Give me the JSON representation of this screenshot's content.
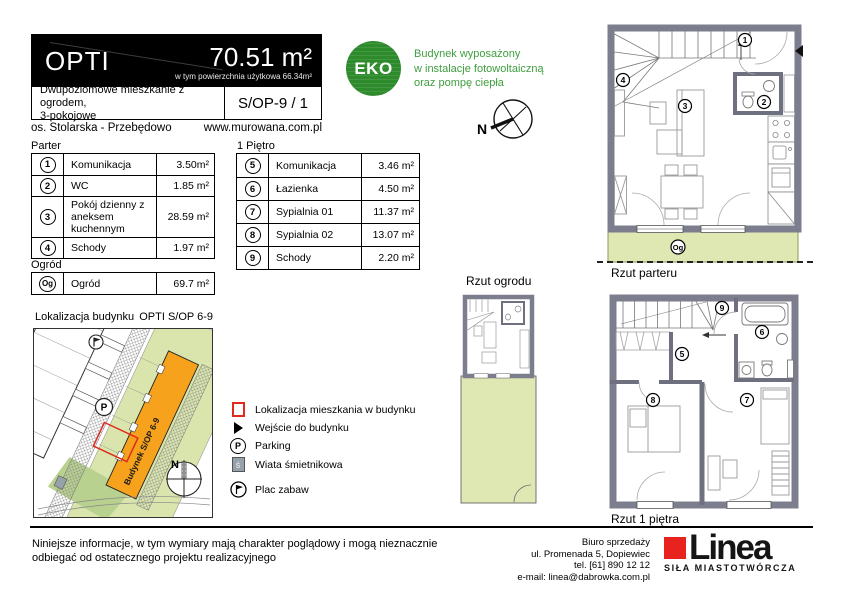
{
  "header": {
    "name": "OPTI",
    "area": "70.51 m²",
    "area_note": "w tym powierzchnia użytkowa  66.34m²",
    "description_line1": "Dwupoziomowe mieszkanie z ogrodem,",
    "description_line2": "3-pokojowe",
    "unit_code": "S/OP-9 / 1",
    "location": "os. Stolarska - Przebędowo",
    "website": "www.murowana.com.pl"
  },
  "eco": {
    "badge": "EKO",
    "line1": "Budynek wyposażony",
    "line2": "w instalacje fotowoltaiczną",
    "line3": "oraz pompę ciepła"
  },
  "compass": {
    "north": "N"
  },
  "tables": {
    "ground_floor": {
      "title": "Parter",
      "rows": [
        {
          "no": "1",
          "room": "Komunikacja",
          "area": "3.50m²"
        },
        {
          "no": "2",
          "room": "WC",
          "area": "1.85 m²"
        },
        {
          "no": "3",
          "room": "Pokój dzienny z aneksem kuchennym",
          "area": "28.59 m²"
        },
        {
          "no": "4",
          "room": "Schody",
          "area": "1.97 m²"
        }
      ]
    },
    "first_floor": {
      "title": "1 Piętro",
      "rows": [
        {
          "no": "5",
          "room": "Komunikacja",
          "area": "3.46 m²"
        },
        {
          "no": "6",
          "room": "Łazienka",
          "area": "4.50 m²"
        },
        {
          "no": "7",
          "room": "Sypialnia 01",
          "area": "11.37 m²"
        },
        {
          "no": "8",
          "room": "Sypialnia 02",
          "area": "13.07 m²"
        },
        {
          "no": "9",
          "room": "Schody",
          "area": "2.20 m²"
        }
      ]
    },
    "garden": {
      "title": "Ogród",
      "rows": [
        {
          "no": "Og",
          "room": "Ogród",
          "area": "69.7 m²"
        }
      ]
    }
  },
  "site_plan": {
    "title": "Lokalizacja budynku",
    "building_code": "OPTI S/OP 6-9",
    "building_label": "Budynek S/OP 6-9",
    "parking_letter": "P",
    "legend": [
      {
        "icon": "red-outline-square",
        "label": "Lokalizacja mieszkania w budynku"
      },
      {
        "icon": "entrance-triangle",
        "label": "Wejście do budynku"
      },
      {
        "icon": "parking-circle",
        "label": "Parking"
      },
      {
        "icon": "trash-shelter-square",
        "label": "Wiata śmietnikowa"
      },
      {
        "icon": "playground-circle",
        "label": "Plac zabaw"
      }
    ]
  },
  "floor_plans": {
    "ground": {
      "label": "Rzut parteru",
      "markers": [
        "1",
        "2",
        "3",
        "4"
      ],
      "garden_marker": "Og"
    },
    "garden_view": {
      "label": "Rzut ogrodu"
    },
    "first": {
      "label": "Rzut 1 piętra",
      "markers": [
        "5",
        "6",
        "7",
        "8",
        "9"
      ]
    }
  },
  "footer": {
    "disclaimer_line1": "Niniejsze informacje, w tym wymiary mają charakter poglądowy i mogą nieznacznie",
    "disclaimer_line2": "odbiegać od ostatecznego projektu realizacyjnego",
    "sales_office": {
      "line1": "Biuro sprzedaży",
      "line2": "ul. Promenada 5, Dopiewiec",
      "line3": "tel. [61] 890 12 12",
      "line4": "e-mail: linea@dabrowka.com.pl"
    },
    "logo": {
      "name": "Linea",
      "tagline": "SIŁA MIASTOTWÓRCZA"
    }
  },
  "colors": {
    "eco_green": "#2e8b2c",
    "eco_text_green": "#3f9e3f",
    "garden_green": "#dfe7b2",
    "building_orange": "#f6a21d",
    "unit_highlight_red": "#e02a1e",
    "logo_red": "#e8231f",
    "wall_gray": "#7c7e8d"
  }
}
